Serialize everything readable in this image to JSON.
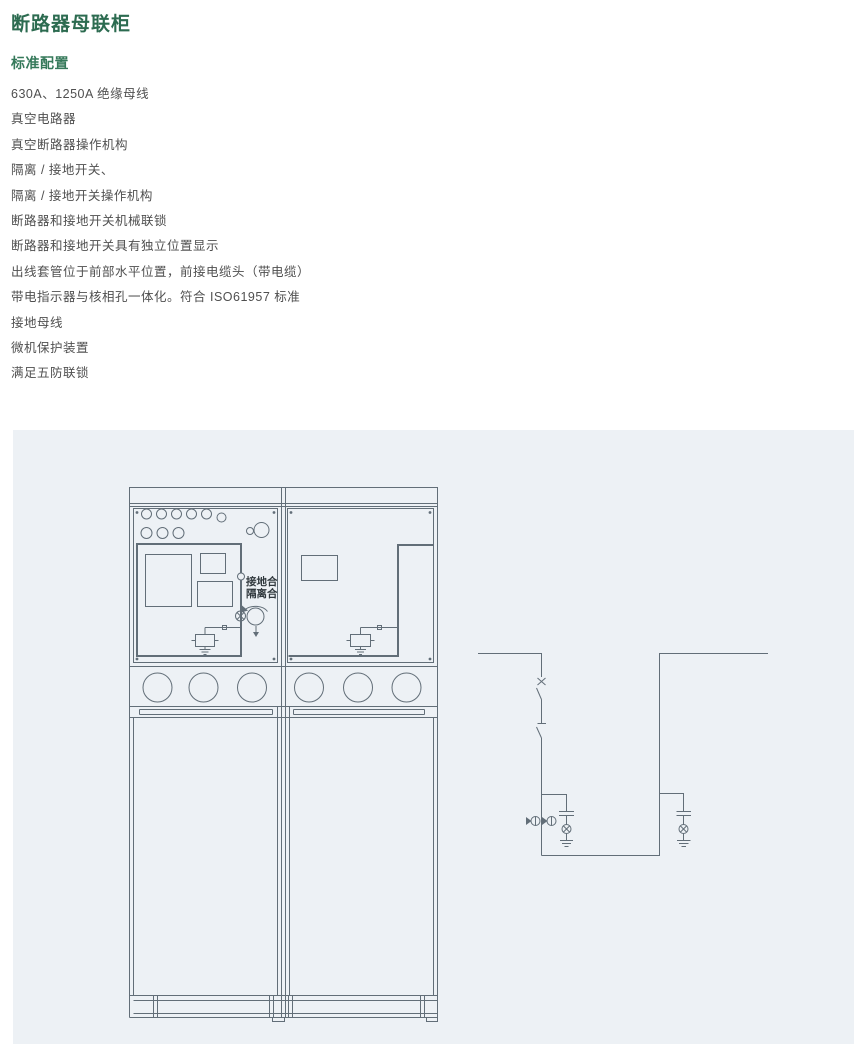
{
  "page": {
    "title": "断路器母联柜",
    "subtitle": "标准配置",
    "features": [
      "630A、1250A 绝缘母线",
      "真空电路器",
      "真空断路器操作机构",
      "隔离 / 接地开关、",
      "隔离 / 接地开关操作机构",
      "断路器和接地开关机械联锁",
      "断路器和接地开关具有独立位置显示",
      "出线套管位于前部水平位置，前接电缆头（带电缆）",
      "带电指示器与核相孔一体化。符合 ISO61957 标准",
      "接地母线",
      "微机保护装置",
      "满足五防联锁"
    ]
  },
  "diagram": {
    "labels": {
      "switch_position_line1": "接地合",
      "switch_position_line2": "隔离合"
    }
  },
  "theme": {
    "title-color": "#2c6b50",
    "subtitle-color": "#35795a",
    "text-color": "#4f4f4f",
    "panel-bg": "#edf1f5",
    "line-color": "#626e78"
  }
}
